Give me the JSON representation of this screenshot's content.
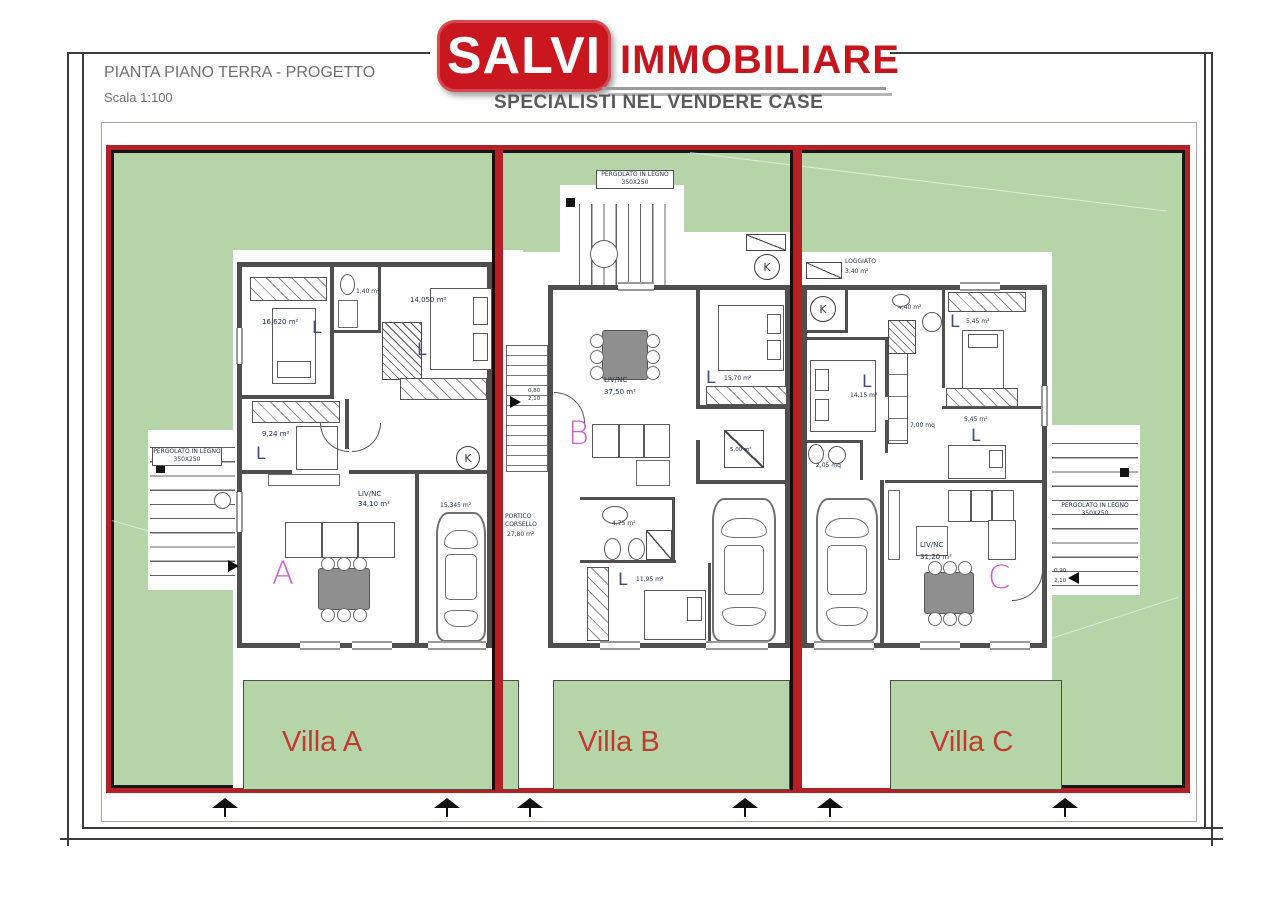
{
  "header": {
    "title": "PIANTA PIANO TERRA - PROGETTO",
    "scale": "Scala 1:100"
  },
  "logo": {
    "brand": "SALVI",
    "brand_suffix": "IMMOBILIARE",
    "tagline": "SPECIALISTI NEL VENDERE CASE"
  },
  "colors": {
    "plot_green": "#b5d4a8",
    "boundary_red": "#b32025",
    "logo_red": "#c9161f",
    "villa_label_red": "#c23b2e",
    "unit_letter_magenta": "#cb5fcb",
    "wall_gray": "#4f4f4f"
  },
  "villas": {
    "a": {
      "name": "Villa A",
      "letter": "A",
      "l": "L",
      "rooms": {
        "bed1": "16,620 m²",
        "bed2": "9,24 m²",
        "bed3": "14,050 m²",
        "bath": "1,40 m²",
        "living": "LIV/NC",
        "living_area": "34,10 m²",
        "garage": "15,345 m²"
      }
    },
    "b": {
      "name": "Villa B",
      "letter": "B",
      "l": "L",
      "rooms": {
        "living": "LIV/NC",
        "living_area": "37,50 m²",
        "bed1": "15,70 m²",
        "bed2": "11,95 m²",
        "bath": "4,75 m²",
        "store": "5,00 m²",
        "portico": "PORTICO CORSELLO",
        "portico_area": "27,80 m²"
      }
    },
    "c": {
      "name": "Villa C",
      "letter": "C",
      "l": "L",
      "rooms": {
        "loggiato": "LOGGIATO",
        "loggiato_area": "3,40 m²",
        "bath1": "4,40 m²",
        "bath2": "2,05 mq",
        "bed1": "14,15 m²",
        "bed2": "5,45 m²",
        "bed3": "5,45 m²",
        "corridor": "7,00 mq",
        "living": "LIV/NC",
        "living_area": "31,20 m²"
      }
    }
  },
  "annotations": {
    "pergola": "PERGOLATO IN LEGNO",
    "pergola_dim": "350X250",
    "k": "K",
    "door_w": "0,90",
    "door_h": "2,10",
    "door_w2": "0,80"
  }
}
